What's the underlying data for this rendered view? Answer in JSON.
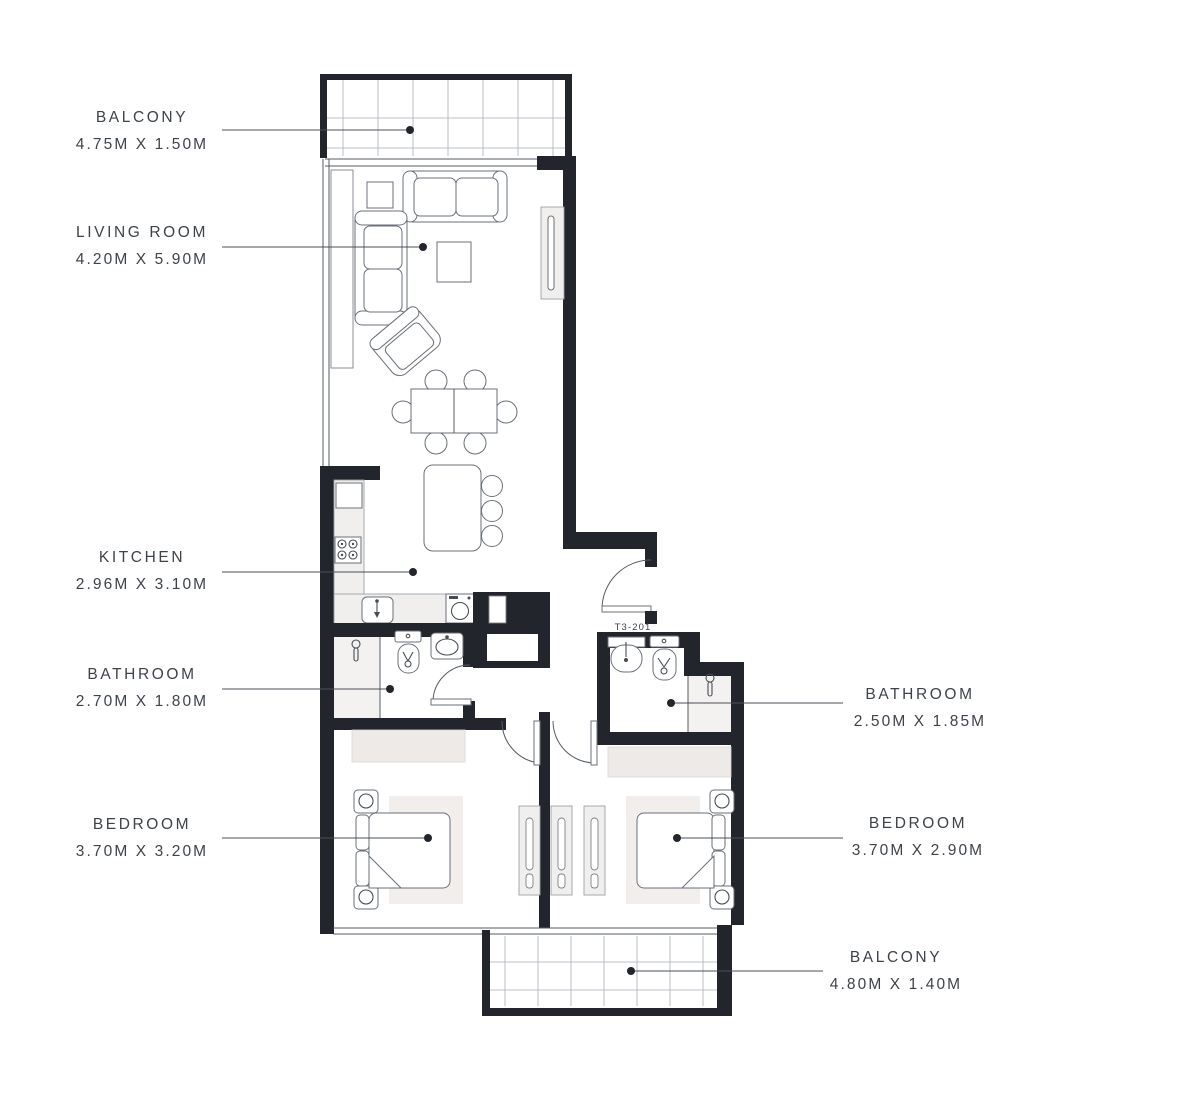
{
  "unit_label": "T3-201",
  "labels": {
    "balcony_top": {
      "name": "BALCONY",
      "dims": "4.75M X 1.50M"
    },
    "living_room": {
      "name": "LIVING ROOM",
      "dims": "4.20M X 5.90M"
    },
    "kitchen": {
      "name": "KITCHEN",
      "dims": "2.96M X 3.10M"
    },
    "bathroom_1": {
      "name": "BATHROOM",
      "dims": "2.70M X 1.80M"
    },
    "bedroom_1": {
      "name": "BEDROOM",
      "dims": "3.70M X 3.20M"
    },
    "bathroom_2": {
      "name": "BATHROOM",
      "dims": "2.50M X 1.85M"
    },
    "bedroom_2": {
      "name": "BEDROOM",
      "dims": "3.70M X 2.90M"
    },
    "balcony_bottom": {
      "name": "BALCONY",
      "dims": "4.80M X 1.40M"
    }
  },
  "colors": {
    "wall": "#22262c",
    "text": "#3d434b",
    "furniture_line": "#6a7078",
    "light_fill": "#f1efed",
    "background": "#ffffff"
  }
}
